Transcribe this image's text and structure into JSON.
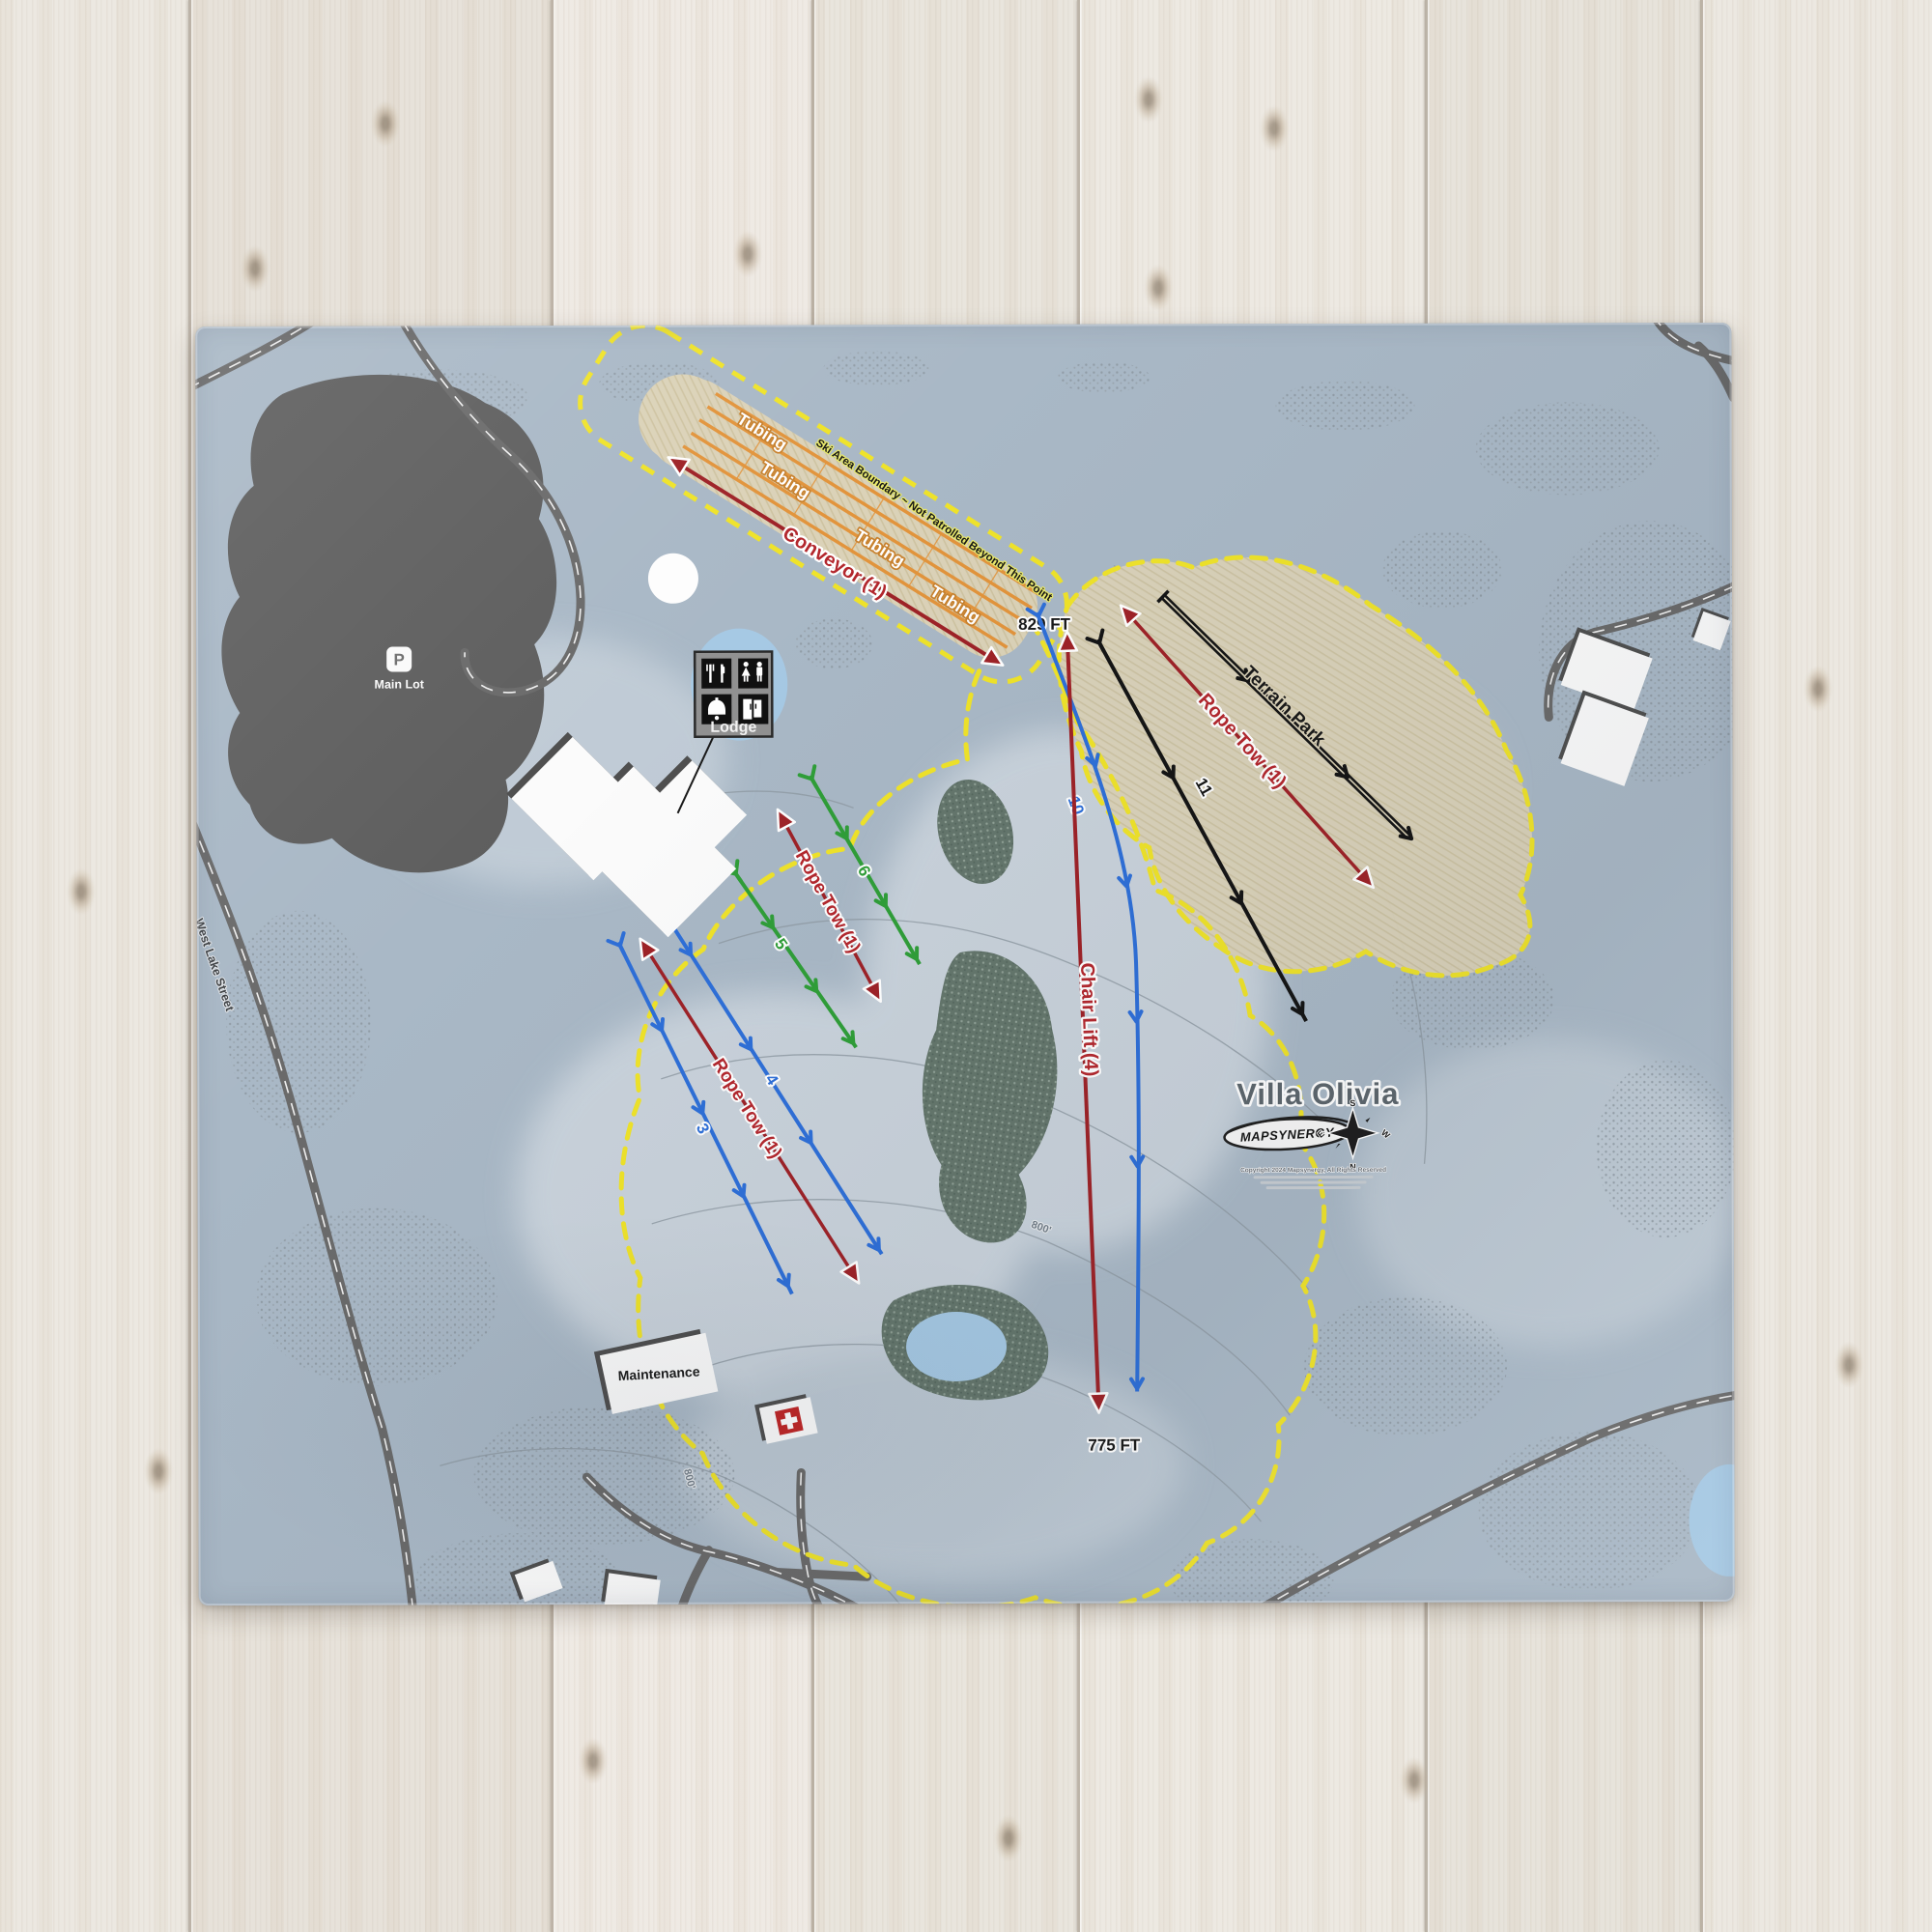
{
  "photo": {
    "subject": "throw blanket printed with a ski resort trail map, lying on a whitewashed wood plank floor"
  },
  "map": {
    "title": "Villa Olivia",
    "logo_text": "MAPSYNERGY",
    "copyright": "Copyright 2024 Mapsynergy, All Rights Reserved",
    "boundary_note": "Ski Area Boundary ~ Not Patrolled Beyond This Point",
    "elevations": {
      "summit": "829 FT",
      "base": "775 FT"
    },
    "compass": {
      "top": "S",
      "bottom": "N",
      "left": "E",
      "right": "W"
    },
    "lifts": {
      "conveyor": {
        "label": "Conveyor (1)",
        "color": "#a8232a"
      },
      "rope_tow_terrain": {
        "label": "Rope Tow (1)",
        "color": "#a8232a"
      },
      "rope_tow_mid": {
        "label": "Rope Tow (1)",
        "color": "#a8232a"
      },
      "rope_tow_lower": {
        "label": "Rope Tow (1)",
        "color": "#a8232a"
      },
      "chair_lift": {
        "label": "Chair Lift (4)",
        "color": "#a8232a"
      }
    },
    "trails": {
      "t3": {
        "label": "3",
        "color": "#2e6fd8",
        "difficulty": "blue"
      },
      "t4": {
        "label": "4",
        "color": "#2e6fd8",
        "difficulty": "blue"
      },
      "t5": {
        "label": "5",
        "color": "#2f9e38",
        "difficulty": "green"
      },
      "t6": {
        "label": "6",
        "color": "#2f9e38",
        "difficulty": "green"
      },
      "t10": {
        "label": "10",
        "color": "#2e6fd8",
        "difficulty": "blue"
      },
      "t11": {
        "label": "11",
        "color": "#141414",
        "difficulty": "black"
      },
      "terrain_park": {
        "label": "Terrain Park",
        "color": "#141414",
        "difficulty": "black"
      }
    },
    "tubing_labels": [
      "Tubing",
      "Tubing",
      "Tubing",
      "Tubing"
    ],
    "pois": {
      "main_lot": {
        "label": "Main Lot",
        "symbol": "P"
      },
      "lodge": {
        "label": "Lodge"
      },
      "maintenance": {
        "label": "Maintenance"
      }
    },
    "roads": {
      "west_lake_street": "West Lake Street"
    },
    "contour_labels": {
      "a": "800'",
      "b": "800'"
    },
    "colors": {
      "boundary_yellow": "#efe32a",
      "tubing_orange": "#e2943c",
      "lift_red": "#9e2227",
      "terrain_tan": "#dbd2b8",
      "map_base": "#a9b8c6",
      "pond_blue": "#a6c9e4"
    }
  }
}
